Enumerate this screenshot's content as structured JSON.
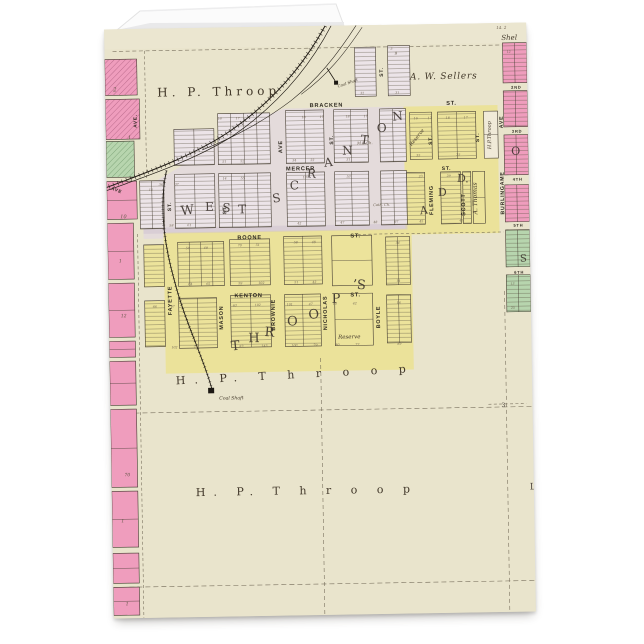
{
  "product": {
    "kind_note": "folded greeting card mockup with vintage plat map print"
  },
  "colors": {
    "page_bg": "#ffffff",
    "paper": "#e9e4cc",
    "lavender_block": "#ece4e8",
    "lavender_wash": "#e2d8de",
    "yellow_block": "#ece39b",
    "yellow_wash": "#ebe29a",
    "pink_block": "#ef9dbd",
    "green_block": "#b7d5ae",
    "ink": "#3a3228",
    "railroad": "#211c15",
    "dash_line": "#6f6654"
  },
  "map": {
    "owners": [
      "H. P. Throop",
      "A. W. Sellers",
      "A. Thomas"
    ],
    "plat_names": [
      "WEST SCRANTON",
      "THROOP'S",
      "ADD"
    ],
    "streets": [
      "BRACKEN",
      "MERCER",
      "BOONE",
      "KENTON",
      "FAYETTE",
      "MASON",
      "BROWNIE",
      "NICHOLAS",
      "BOYLE",
      "FLEMING",
      "SCOTT",
      "BURLINGAME AVE",
      "2ND",
      "3RD",
      "4TH",
      "5TH",
      "6TH"
    ],
    "labels": [
      {
        "t": "H. P. Throop",
        "x": 52,
        "y": 68,
        "s": 12,
        "sp": 4,
        "c": "name"
      },
      {
        "t": "A. W. Sellers",
        "x": 305,
        "y": 55,
        "s": 9,
        "sp": 0.8,
        "c": "nameit"
      },
      {
        "t": "Shel",
        "x": 397,
        "y": 17,
        "s": 7,
        "c": "nameit"
      },
      {
        "t": "14. 2",
        "x": 392,
        "y": 6,
        "s": 4,
        "c": "tiny"
      },
      {
        "t": "BRACKEN",
        "x": 221,
        "y": 81,
        "s": 5.6,
        "a": "m",
        "c": "st",
        "sp": 1.2
      },
      {
        "t": "ST.",
        "x": 346,
        "y": 81,
        "s": 5.6,
        "a": "m",
        "c": "st"
      },
      {
        "t": "MERCER",
        "x": 194,
        "y": 144,
        "s": 5.6,
        "a": "m",
        "c": "st",
        "sp": 1
      },
      {
        "t": "BOONE",
        "x": 142,
        "y": 212,
        "s": 5.6,
        "a": "m",
        "c": "st",
        "sp": 1.4
      },
      {
        "t": "ST.",
        "x": 248,
        "y": 212,
        "s": 5.6,
        "a": "m",
        "c": "st"
      },
      {
        "t": "KENTON",
        "x": 140,
        "y": 270,
        "s": 5.6,
        "a": "m",
        "c": "st",
        "sp": 1
      },
      {
        "t": "ST.",
        "x": 247,
        "y": 271,
        "s": 5.6,
        "a": "m",
        "c": "st"
      },
      {
        "t": "AVE",
        "x": 176,
        "y": 120,
        "s": 5.4,
        "r": -90,
        "a": "m",
        "c": "st"
      },
      {
        "t": "ST.",
        "x": 227,
        "y": 114,
        "s": 5,
        "r": -90,
        "a": "m",
        "c": "st"
      },
      {
        "t": "ST.",
        "x": 64,
        "y": 178,
        "s": 5,
        "r": -90,
        "a": "m",
        "c": "st"
      },
      {
        "t": "ST.",
        "x": 119,
        "y": 182,
        "s": 5,
        "r": -90,
        "a": "m",
        "c": "st"
      },
      {
        "t": "ST.",
        "x": 278,
        "y": 47,
        "s": 5,
        "r": -90,
        "a": "m",
        "c": "st"
      },
      {
        "t": "ST.",
        "x": 326,
        "y": 116,
        "s": 5,
        "r": -90,
        "a": "m",
        "c": "st"
      },
      {
        "t": "ST.",
        "x": 373,
        "y": 114,
        "s": 5,
        "r": -90,
        "a": "m",
        "c": "st"
      },
      {
        "t": "ST.",
        "x": 340,
        "y": 146,
        "s": 5,
        "a": "m",
        "c": "st"
      },
      {
        "t": "FAYETTE",
        "x": 63,
        "y": 272,
        "s": 5.4,
        "r": -90,
        "a": "m",
        "c": "st"
      },
      {
        "t": "MASON",
        "x": 114,
        "y": 290,
        "s": 5.4,
        "r": -90,
        "a": "m",
        "c": "st"
      },
      {
        "t": "BROWNIE",
        "x": 166,
        "y": 288,
        "s": 5.4,
        "r": -90,
        "a": "m",
        "c": "st"
      },
      {
        "t": "NICHOLAS",
        "x": 218,
        "y": 287,
        "s": 5.4,
        "r": -90,
        "a": "m",
        "c": "st"
      },
      {
        "t": "BOYLE",
        "x": 271,
        "y": 292,
        "s": 5.4,
        "r": -90,
        "a": "m",
        "c": "st"
      },
      {
        "t": "FLEMING",
        "x": 326,
        "y": 176,
        "s": 5.4,
        "r": -90,
        "a": "m",
        "c": "st"
      },
      {
        "t": "SCOTT",
        "x": 358,
        "y": 181,
        "s": 5.4,
        "r": -90,
        "a": "m",
        "c": "st"
      },
      {
        "t": "A. Thomas",
        "x": 370,
        "y": 175,
        "s": 6,
        "r": -90,
        "a": "m",
        "c": "nameit"
      },
      {
        "t": "H.P.Throop",
        "x": 385,
        "y": 112,
        "s": 5,
        "r": -90,
        "a": "m",
        "c": "nameit"
      },
      {
        "t": "BURLINGAME",
        "x": 397,
        "y": 170,
        "s": 5.2,
        "r": -90,
        "a": "m",
        "c": "st"
      },
      {
        "t": "AVE",
        "x": 397,
        "y": 99,
        "s": 5.2,
        "r": -90,
        "a": "m",
        "c": "st"
      },
      {
        "t": "Reserve",
        "x": 312,
        "y": 114,
        "s": 5,
        "r": -50,
        "a": "m",
        "c": "nameit"
      },
      {
        "t": "Reserve",
        "x": 240,
        "y": 313,
        "s": 5.5,
        "a": "m",
        "c": "nameit"
      },
      {
        "t": "M.E.Ch.",
        "x": 251,
        "y": 119,
        "s": 3.8,
        "c": "tiny"
      },
      {
        "t": "Cath. Ch.",
        "x": 266,
        "y": 181,
        "s": 3.6,
        "c": "tiny"
      },
      {
        "t": "Coal Shaft",
        "x": 233,
        "y": 62,
        "s": 4,
        "r": -18,
        "c": "nameit"
      },
      {
        "t": "Coal Shaft",
        "x": 109,
        "y": 372,
        "s": 4.6,
        "c": "nameit"
      },
      {
        "t": "W",
        "x": 74,
        "y": 187,
        "s": 13,
        "r": -6,
        "c": "plat"
      },
      {
        "t": "E",
        "x": 98,
        "y": 183,
        "s": 12,
        "c": "plat"
      },
      {
        "t": "S",
        "x": 115,
        "y": 184,
        "s": 12,
        "r": 4,
        "c": "plat"
      },
      {
        "t": "T",
        "x": 131,
        "y": 186,
        "s": 12,
        "c": "plat"
      },
      {
        "t": "S",
        "x": 166,
        "y": 176,
        "s": 12,
        "r": -8,
        "c": "plat"
      },
      {
        "t": "C",
        "x": 183,
        "y": 163,
        "s": 12,
        "c": "plat"
      },
      {
        "t": "R",
        "x": 200,
        "y": 151,
        "s": 12,
        "r": 6,
        "c": "plat"
      },
      {
        "t": "A",
        "x": 218,
        "y": 141,
        "s": 12,
        "r": -6,
        "c": "plat"
      },
      {
        "t": "N",
        "x": 236,
        "y": 129,
        "s": 12,
        "c": "plat"
      },
      {
        "t": "T",
        "x": 254,
        "y": 118,
        "s": 12,
        "r": 8,
        "c": "plat"
      },
      {
        "t": "O",
        "x": 271,
        "y": 107,
        "s": 12,
        "c": "plat"
      },
      {
        "t": "N",
        "x": 287,
        "y": 96,
        "s": 12,
        "r": -5,
        "c": "plat"
      },
      {
        "t": "T",
        "x": 122,
        "y": 323,
        "s": 13,
        "r": -5,
        "c": "plat"
      },
      {
        "t": "H",
        "x": 139,
        "y": 315,
        "s": 13,
        "c": "plat"
      },
      {
        "t": "R",
        "x": 155,
        "y": 309,
        "s": 13,
        "r": 6,
        "c": "plat"
      },
      {
        "t": "O",
        "x": 178,
        "y": 299,
        "s": 13,
        "c": "plat"
      },
      {
        "t": "O",
        "x": 200,
        "y": 293,
        "s": 13,
        "r": -6,
        "c": "plat"
      },
      {
        "t": "P",
        "x": 223,
        "y": 277,
        "s": 13,
        "c": "plat"
      },
      {
        "t": "’S",
        "x": 244,
        "y": 263,
        "s": 13,
        "r": 5,
        "c": "plat"
      },
      {
        "t": "A",
        "x": 313,
        "y": 190,
        "s": 11,
        "r": -6,
        "c": "plat"
      },
      {
        "t": "D",
        "x": 331,
        "y": 172,
        "s": 11,
        "c": "plat"
      },
      {
        "t": "D.",
        "x": 350,
        "y": 158,
        "s": 11,
        "r": 5,
        "c": "plat"
      },
      {
        "t": "O",
        "x": 405,
        "y": 132,
        "s": 11,
        "c": "plat"
      },
      {
        "t": "S",
        "x": 412,
        "y": 239,
        "s": 10,
        "c": "plat"
      },
      {
        "t": "H.  P.  T h r o o p",
        "x": 66,
        "y": 356,
        "s": 11,
        "sp": 9,
        "r": -2,
        "c": "name"
      },
      {
        "t": "H.  P.  T h r o o p",
        "x": 84,
        "y": 468,
        "s": 11,
        "sp": 8,
        "c": "name"
      },
      {
        "t": "L",
        "x": 418,
        "y": 467,
        "s": 9,
        "c": "plat"
      },
      {
        "t": "2ND",
        "x": 406,
        "y": 66,
        "s": 4,
        "c": "st"
      },
      {
        "t": "3RD",
        "x": 406,
        "y": 110,
        "s": 4,
        "c": "st"
      },
      {
        "t": "4TH",
        "x": 406,
        "y": 158,
        "s": 4,
        "c": "st"
      },
      {
        "t": "5TH",
        "x": 406,
        "y": 204,
        "s": 4,
        "c": "st"
      },
      {
        "t": "6TH",
        "x": 406,
        "y": 251,
        "s": 4,
        "c": "st"
      },
      {
        "t": "AVE.",
        "x": 31,
        "y": 92,
        "s": 4.6,
        "r": -90,
        "a": "m",
        "c": "st"
      },
      {
        "t": "AVE",
        "x": 4,
        "y": 160,
        "s": 4.6,
        "r": 22,
        "c": "st"
      },
      {
        "t": "2",
        "x": 8,
        "y": 62,
        "s": 5.5,
        "c": "num"
      },
      {
        "t": "1",
        "x": 22,
        "y": 110,
        "s": 5,
        "c": "num"
      },
      {
        "t": "10",
        "x": 13,
        "y": 189,
        "s": 5,
        "c": "num"
      },
      {
        "t": "1",
        "x": 11,
        "y": 233,
        "s": 4.5,
        "c": "num"
      },
      {
        "t": "12",
        "x": 12,
        "y": 288,
        "s": 4.5,
        "c": "num"
      },
      {
        "t": "70",
        "x": 13,
        "y": 447,
        "s": 4.5,
        "c": "num"
      },
      {
        "t": "1",
        "x": 9,
        "y": 493,
        "s": 4.5,
        "c": "num"
      },
      {
        "t": "1",
        "x": 12,
        "y": 576,
        "s": 4.5,
        "c": "num"
      },
      {
        "t": "9",
        "x": 290,
        "y": 30,
        "s": 4,
        "c": "num"
      },
      {
        "t": "3",
        "x": 286,
        "y": 25,
        "s": 3.2,
        "c": "tiny"
      },
      {
        "t": "32",
        "x": 255,
        "y": 69,
        "s": 3.2,
        "c": "tiny"
      },
      {
        "t": "31",
        "x": 290,
        "y": 69,
        "s": 3.2,
        "c": "tiny"
      },
      {
        "t": "3",
        "x": 391,
        "y": 384,
        "s": 6,
        "c": "plat"
      },
      {
        "t": "16",
        "x": 112,
        "y": 92,
        "s": 3.2,
        "c": "tiny"
      },
      {
        "t": "17",
        "x": 130,
        "y": 92,
        "s": 3.2,
        "c": "tiny"
      },
      {
        "t": "18",
        "x": 196,
        "y": 92,
        "s": 3.2,
        "c": "tiny"
      },
      {
        "t": "17",
        "x": 214,
        "y": 92,
        "s": 3.2,
        "c": "tiny"
      },
      {
        "t": "18",
        "x": 240,
        "y": 92,
        "s": 3.2,
        "c": "tiny"
      },
      {
        "t": "17",
        "x": 258,
        "y": 92,
        "s": 3.2,
        "c": "tiny"
      },
      {
        "t": "16",
        "x": 308,
        "y": 95,
        "s": 3.2,
        "c": "tiny"
      },
      {
        "t": "17",
        "x": 322,
        "y": 95,
        "s": 3.2,
        "c": "tiny"
      },
      {
        "t": "18",
        "x": 340,
        "y": 95,
        "s": 3.2,
        "c": "tiny"
      },
      {
        "t": "17",
        "x": 358,
        "y": 95,
        "s": 3.2,
        "c": "tiny"
      },
      {
        "t": "51",
        "x": 116,
        "y": 135,
        "s": 3.2,
        "c": "tiny"
      },
      {
        "t": "52",
        "x": 134,
        "y": 135,
        "s": 3.2,
        "c": "tiny"
      },
      {
        "t": "34",
        "x": 186,
        "y": 135,
        "s": 3.2,
        "c": "tiny"
      },
      {
        "t": "33",
        "x": 204,
        "y": 135,
        "s": 3.2,
        "c": "tiny"
      },
      {
        "t": "31",
        "x": 240,
        "y": 135,
        "s": 3.2,
        "c": "tiny"
      },
      {
        "t": "35",
        "x": 310,
        "y": 132,
        "s": 3.2,
        "c": "tiny"
      },
      {
        "t": "25",
        "x": 350,
        "y": 132,
        "s": 3.2,
        "c": "tiny"
      },
      {
        "t": "14",
        "x": 116,
        "y": 152,
        "s": 3.2,
        "c": "tiny"
      },
      {
        "t": "55",
        "x": 134,
        "y": 152,
        "s": 3.2,
        "c": "tiny"
      },
      {
        "t": "19",
        "x": 196,
        "y": 152,
        "s": 3.2,
        "c": "tiny"
      },
      {
        "t": "53",
        "x": 240,
        "y": 152,
        "s": 3.2,
        "c": "tiny"
      },
      {
        "t": "23",
        "x": 312,
        "y": 153,
        "s": 3.2,
        "c": "tiny"
      },
      {
        "t": "29",
        "x": 340,
        "y": 153,
        "s": 3.2,
        "c": "tiny"
      },
      {
        "t": "58",
        "x": 62,
        "y": 198,
        "s": 3.2,
        "c": "tiny"
      },
      {
        "t": "61",
        "x": 80,
        "y": 198,
        "s": 3.2,
        "c": "tiny"
      },
      {
        "t": "42",
        "x": 190,
        "y": 198,
        "s": 3.2,
        "c": "tiny"
      },
      {
        "t": "47",
        "x": 233,
        "y": 198,
        "s": 3.2,
        "c": "tiny"
      },
      {
        "t": "48",
        "x": 266,
        "y": 198,
        "s": 3.2,
        "c": "tiny"
      },
      {
        "t": "97",
        "x": 287,
        "y": 198,
        "s": 3.2,
        "c": "tiny"
      },
      {
        "t": "45",
        "x": 312,
        "y": 198,
        "s": 3.2,
        "c": "tiny"
      },
      {
        "t": "47",
        "x": 352,
        "y": 198,
        "s": 3.2,
        "c": "tiny"
      },
      {
        "t": "36",
        "x": 52,
        "y": 157,
        "s": 3.2,
        "c": "tiny"
      },
      {
        "t": "37",
        "x": 68,
        "y": 157,
        "s": 3.2,
        "c": "tiny"
      },
      {
        "t": "15",
        "x": 42,
        "y": 162,
        "s": 3.2,
        "c": "tiny"
      },
      {
        "t": "50",
        "x": 78,
        "y": 221,
        "s": 3.2,
        "c": "tiny"
      },
      {
        "t": "49",
        "x": 96,
        "y": 221,
        "s": 3.2,
        "c": "tiny"
      },
      {
        "t": "70",
        "x": 130,
        "y": 219,
        "s": 3.2,
        "c": "tiny"
      },
      {
        "t": "51",
        "x": 148,
        "y": 219,
        "s": 3.2,
        "c": "tiny"
      },
      {
        "t": "58",
        "x": 186,
        "y": 217,
        "s": 3.2,
        "c": "tiny"
      },
      {
        "t": "48",
        "x": 204,
        "y": 217,
        "s": 3.2,
        "c": "tiny"
      },
      {
        "t": "54",
        "x": 288,
        "y": 219,
        "s": 3.2,
        "c": "tiny"
      },
      {
        "t": "64",
        "x": 80,
        "y": 257,
        "s": 3.2,
        "c": "tiny"
      },
      {
        "t": "65",
        "x": 98,
        "y": 257,
        "s": 3.2,
        "c": "tiny"
      },
      {
        "t": "59",
        "x": 130,
        "y": 257,
        "s": 3.2,
        "c": "tiny"
      },
      {
        "t": "102",
        "x": 150,
        "y": 257,
        "s": 3.2,
        "c": "tiny"
      },
      {
        "t": "51",
        "x": 186,
        "y": 257,
        "s": 3.2,
        "c": "tiny"
      },
      {
        "t": "43",
        "x": 204,
        "y": 257,
        "s": 3.2,
        "c": "tiny"
      },
      {
        "t": "14",
        "x": 288,
        "y": 257,
        "s": 3.2,
        "c": "tiny"
      },
      {
        "t": "66",
        "x": 44,
        "y": 279,
        "s": 3.2,
        "c": "tiny"
      },
      {
        "t": "67",
        "x": 62,
        "y": 279,
        "s": 3.2,
        "c": "tiny"
      },
      {
        "t": "63",
        "x": 124,
        "y": 279,
        "s": 3.2,
        "c": "tiny"
      },
      {
        "t": "102",
        "x": 146,
        "y": 279,
        "s": 3.2,
        "c": "tiny"
      },
      {
        "t": "101",
        "x": 178,
        "y": 279,
        "s": 3.2,
        "c": "tiny"
      },
      {
        "t": "47",
        "x": 200,
        "y": 279,
        "s": 3.2,
        "c": "tiny"
      },
      {
        "t": "10",
        "x": 224,
        "y": 279,
        "s": 3.2,
        "c": "tiny"
      },
      {
        "t": "42",
        "x": 244,
        "y": 279,
        "s": 3.2,
        "c": "tiny"
      },
      {
        "t": "16",
        "x": 288,
        "y": 279,
        "s": 3.2,
        "c": "tiny"
      },
      {
        "t": "102",
        "x": 62,
        "y": 320,
        "s": 3.2,
        "c": "tiny"
      },
      {
        "t": "73",
        "x": 84,
        "y": 320,
        "s": 3.2,
        "c": "tiny"
      },
      {
        "t": "83",
        "x": 130,
        "y": 320,
        "s": 3.2,
        "c": "tiny"
      },
      {
        "t": "143",
        "x": 152,
        "y": 320,
        "s": 3.2,
        "c": "tiny"
      },
      {
        "t": "100",
        "x": 182,
        "y": 320,
        "s": 3.2,
        "c": "tiny"
      },
      {
        "t": "79",
        "x": 204,
        "y": 320,
        "s": 3.2,
        "c": "tiny"
      },
      {
        "t": "80",
        "x": 226,
        "y": 320,
        "s": 3.2,
        "c": "tiny"
      },
      {
        "t": "72",
        "x": 246,
        "y": 320,
        "s": 3.2,
        "c": "tiny"
      },
      {
        "t": "89",
        "x": 288,
        "y": 320,
        "s": 3.2,
        "c": "tiny"
      },
      {
        "t": "12",
        "x": 402,
        "y": 30,
        "s": 3.2,
        "c": "tiny"
      },
      {
        "t": "13",
        "x": 402,
        "y": 262,
        "s": 3.2,
        "c": "tiny"
      },
      {
        "t": "25",
        "x": 402,
        "y": 286,
        "s": 3.2,
        "c": "tiny"
      }
    ]
  }
}
